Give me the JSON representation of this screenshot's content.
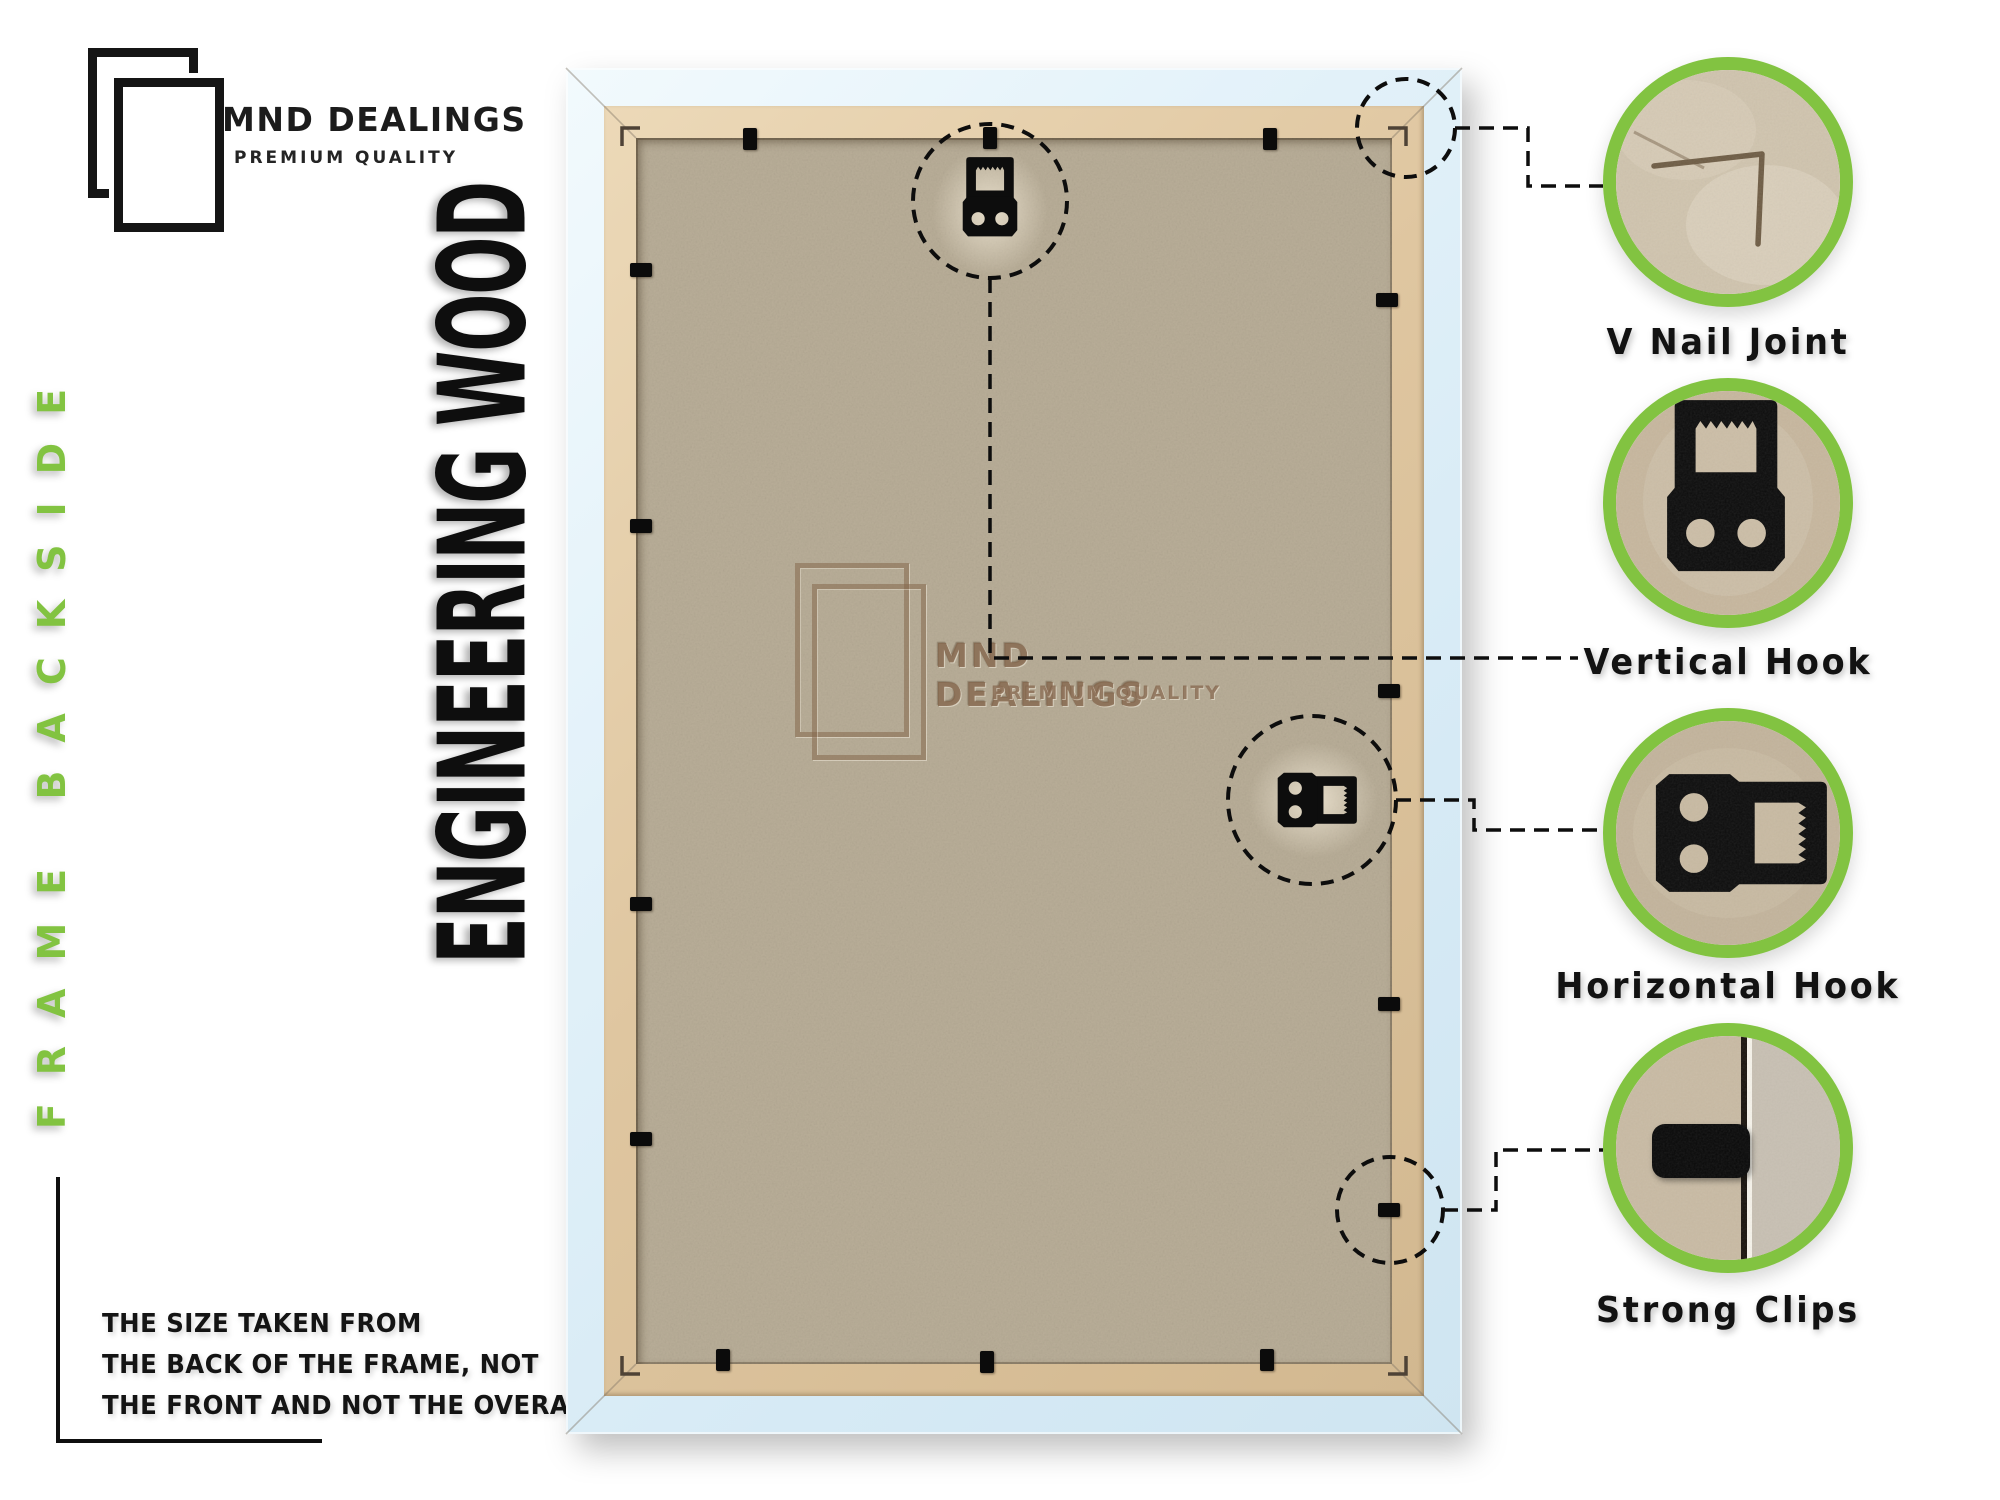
{
  "brand": {
    "name": "MND DEALINGS",
    "tagline": "PREMIUM QUALITY"
  },
  "side_label": "FRAME BACKSIDE",
  "headline": "ENGINEERING WOOD",
  "note": {
    "line1": "THE SIZE TAKEN FROM",
    "line2": "THE BACK OF THE FRAME, NOT",
    "line3": "THE FRONT AND NOT THE OVERALL SIZE."
  },
  "watermark": {
    "name": "MND DEALINGS",
    "tagline": "PREMIUM QUALITY"
  },
  "callouts": [
    {
      "id": "v-nail-joint",
      "label": "V Nail Joint"
    },
    {
      "id": "vertical-hook",
      "label": "Vertical Hook"
    },
    {
      "id": "horizontal-hook",
      "label": "Horizontal Hook"
    },
    {
      "id": "strong-clips",
      "label": "Strong Clips"
    }
  ],
  "colors": {
    "accent_green": "#82c341",
    "ink": "#111111",
    "mdf_board": "#b9ae98",
    "lip_tan": "#dfc6a0",
    "frame_white_blue": "#dceef7"
  }
}
